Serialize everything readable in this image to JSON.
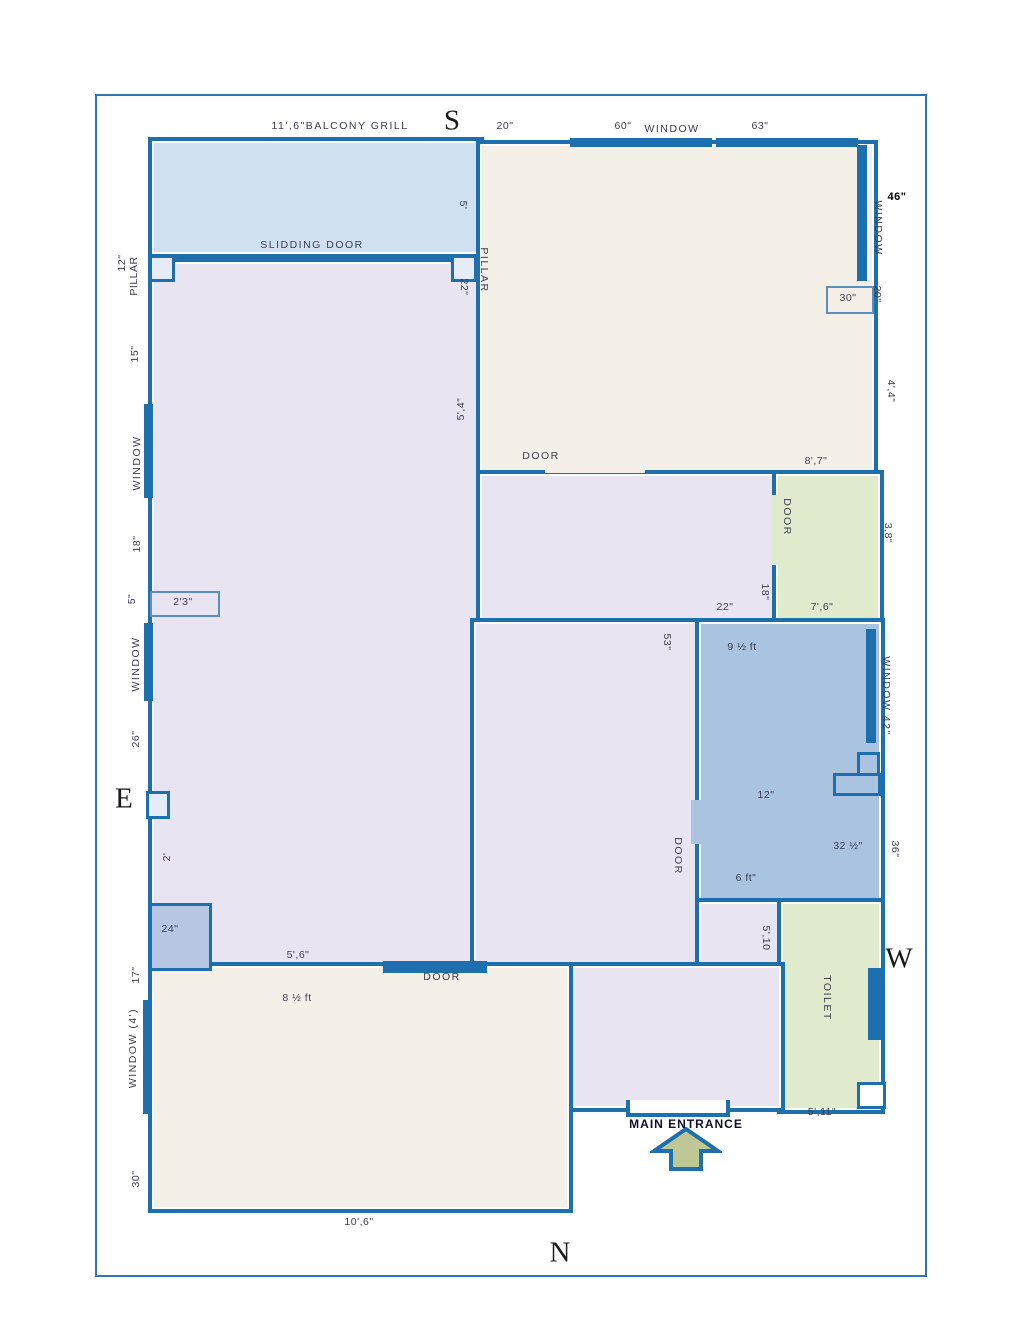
{
  "compass": {
    "s": "S",
    "e": "E",
    "w": "W",
    "n": "N"
  },
  "colors": {
    "wall": "#1e6fae",
    "page_border": "#2e75b6",
    "balcony": "#cfe1f0",
    "beige": "#f5f0e7",
    "lavender": "#e8e4f2",
    "blue_room": "#a9c3e1",
    "green": "#e0eacd",
    "box_blue": "#b7c7e3",
    "arrow": "#bfc795"
  },
  "labels": {
    "balcony_grill": "11',6\"BALCONY GRILL",
    "slidding_door": "SLIDDING DOOR",
    "d5_balcony": "5'",
    "d20_top": "20\"",
    "d60": "60\"",
    "window_top": "WINDOW",
    "d63": "63\"",
    "d12_pillar": "12\"",
    "pillar_left": "PILLAR",
    "d22_pillar": "22\"",
    "pillar_center": "PILLAR",
    "d15": "15\"",
    "window_left1": "WINDOW",
    "d18_left": "18\"",
    "d5_left": "5\"",
    "d2_3": "2'3\"",
    "window_left2": "WINDOW",
    "d26": "26\"",
    "d2": "2'",
    "d24": "24\"",
    "d17": "17\"",
    "window_4ft": "WINDOW  (4')",
    "d30_left": "30\"",
    "d10_6": "10',6\"",
    "d5_4": "5',4\"",
    "door_top": "DOOR",
    "d8_7": "8',7\"",
    "window_right_top": "WINDOW",
    "d46": "46\"",
    "d20_right": "20\"",
    "d30_box": "30\"",
    "d4_4": "4',4\"",
    "door_green": "DOOR",
    "d3_8": "3,8\"",
    "d7_6": "7',6\"",
    "d18_mid": "18\"",
    "d22_mid": "22\"",
    "d53": "53\"",
    "d9half": "9 ½ ft",
    "d12_room": "12\"",
    "d32": "32 ½\"",
    "d6ft": "6 ft\"",
    "window_42": "WINDOW 42\"",
    "d36": "36\"",
    "door_mid": "DOOR",
    "d5_10": "5',10",
    "toilet": "TOILET",
    "d5_11": "5',11\"",
    "w_label": "W",
    "d5_6": "5',6\"",
    "door_bottom": "DOOR",
    "d8half": "8 ½ ft",
    "main_entrance": "MAIN ENTRANCE"
  }
}
